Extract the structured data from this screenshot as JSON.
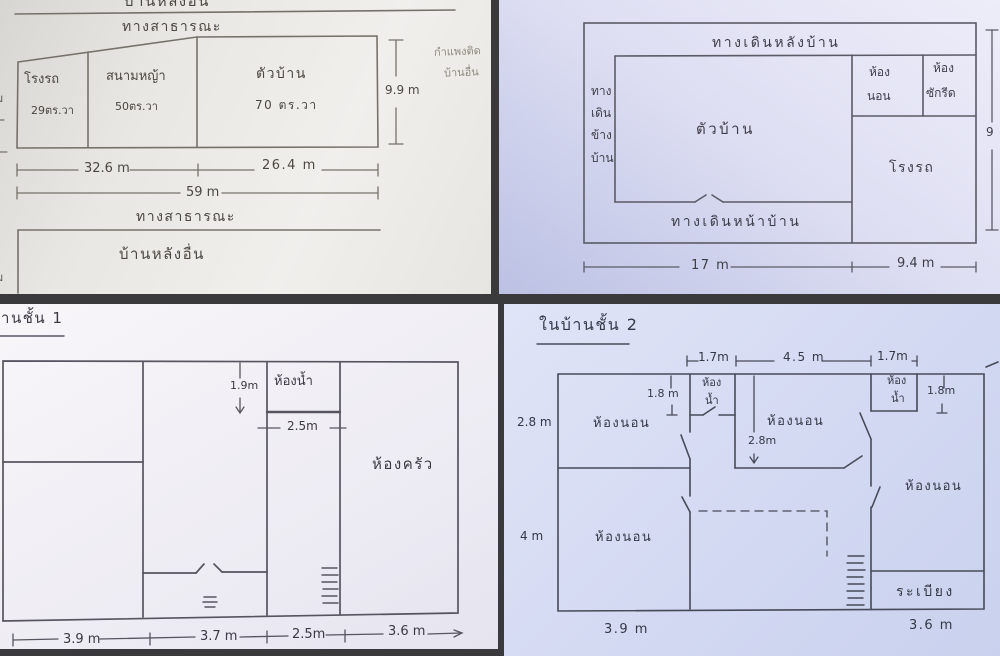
{
  "site_plan": {
    "neighbor_house_top": "บ้านหลังอื่น",
    "public_road_top": "ทางสาธารณะ",
    "rooms": {
      "garage_label": "โรงรถ",
      "garage_area": "29ตร.วา",
      "lawn_label": "สนามหญ้า",
      "lawn_area": "50ตร.วา",
      "house_label": "ตัวบ้าน",
      "house_area": "70 ตร.วา"
    },
    "left_edge_partial_1": "ม",
    "left_edge_partial_2": "ม",
    "dim_garage_lawn": "32.6 m",
    "dim_house": "26.4 m",
    "dim_total_width": "59 m",
    "dim_depth": "9.9 m",
    "wall_note_line1": "กำแพงติด",
    "wall_note_line2": "บ้านอื่น",
    "public_road_bottom": "ทางสาธารณะ",
    "neighbor_house_bottom": "บ้านหลังอื่น"
  },
  "house_layout": {
    "walkway_back": "ทางเดินหลังบ้าน",
    "walkway_side": [
      "ทาง",
      "เดิน",
      "ข้าง",
      "บ้าน"
    ],
    "house_label": "ตัวบ้าน",
    "bedroom_line1": "ห้อง",
    "bedroom_line2": "นอน",
    "laundry_line1": "ห้อง",
    "laundry_line2": "ซักรีด",
    "garage_label": "โรงรถ",
    "walkway_front": "ทางเดินหน้าบ้าน",
    "dim_house_width": "17 m",
    "dim_garage_width": "9.4 m",
    "right_edge_partial": "9"
  },
  "floor1": {
    "title": "บ้านชั้น 1",
    "bathroom_label": "ห้องน้ำ",
    "kitchen_label": "ห้องครัว",
    "dim_bath_depth": "1.9m",
    "dim_bath_width": "2.5m",
    "dim_bottom_1": "3.9 m",
    "dim_bottom_2": "3.7 m",
    "dim_bottom_3": "2.5m",
    "dim_bottom_4": "3.6 m"
  },
  "floor2": {
    "title": "ในบ้านชั้น 2",
    "dim_top_1": "1.7m",
    "dim_top_2": "4.5 m",
    "dim_top_3": "1.7m",
    "dim_left_upper": "2.8 m",
    "dim_left_lower": "4 m",
    "dim_bath_left": "1.8 m",
    "dim_bath_right": "1.8m",
    "dim_mid": "2.8m",
    "bedroom_upper_left": "ห้องนอน",
    "bedroom_middle": "ห้องนอน",
    "bedroom_right": "ห้องนอน",
    "bedroom_lower_left": "ห้องนอน",
    "bath_left_line1": "ห้อง",
    "bath_left_line2": "น้ำ",
    "bath_right_line1": "ห้อง",
    "bath_right_line2": "น้ำ",
    "balcony_label": "ระเบียง",
    "dim_bottom_left": "3.9 m",
    "dim_bottom_right": "3.6 m"
  }
}
